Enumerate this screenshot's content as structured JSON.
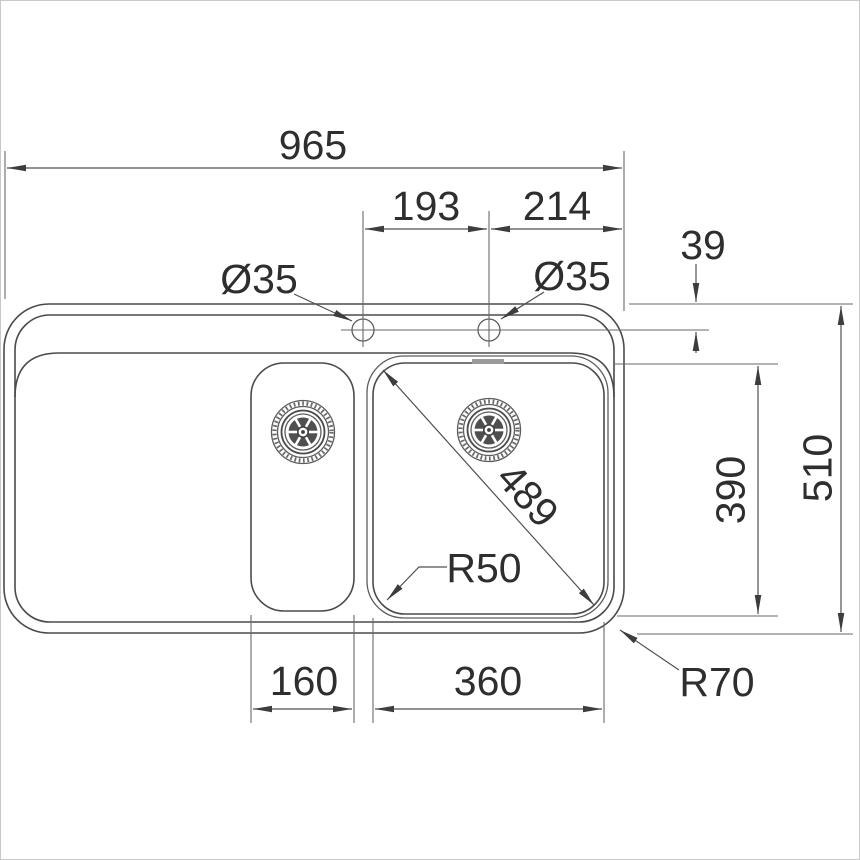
{
  "drawing": {
    "type": "technical-drawing",
    "subject": "double-bowl kitchen sink with drainer, plan view"
  },
  "colors": {
    "background": "#ffffff",
    "object_line": "#4b4b4b",
    "dimension_line": "#4f4f4f",
    "text": "#2e2e2e",
    "overflow_mark": "#9b9b9b",
    "frame": "#c9c9c9"
  },
  "dims": {
    "overall_width": "965",
    "tap_spacing_left": "193",
    "tap_spacing_right": "214",
    "tap_hole_left_dia": "Ø35",
    "tap_hole_right_dia": "Ø35",
    "tap_centerline_inset": "39",
    "overall_depth": "510",
    "bowl_depth": "390",
    "bowl_diagonal": "489",
    "bowl_corner_radius": "R50",
    "outer_corner_radius": "R70",
    "small_bowl_width": "160",
    "main_bowl_width": "360"
  }
}
